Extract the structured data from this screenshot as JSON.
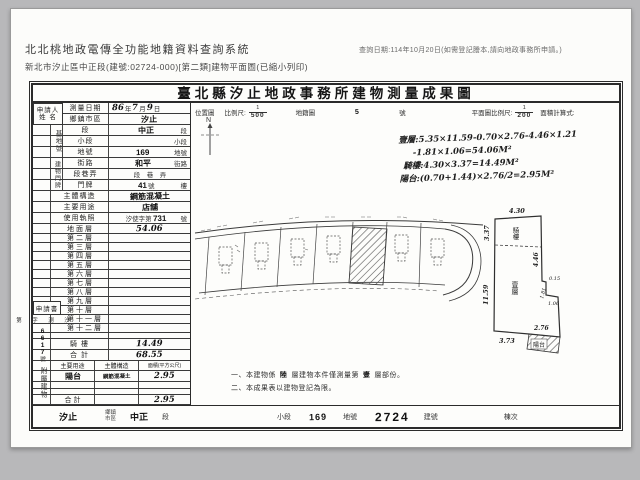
{
  "header": {
    "system_title": "北北桃地政電傳全功能地籍資料查詢系統",
    "query_date": "查詢日期:114年10月20日(如需登記謄本,請向地政事務所申請。)",
    "subtitle": "新北市汐止區中正段(建號:02724-000)[第二類]建物平面圖(已縮小列印)"
  },
  "doc": {
    "title": "臺北縣汐止地政事務所建物測量成果圖",
    "scalebar": {
      "loc": "位置圖",
      "scale": "比例尺:",
      "num1": "1",
      "den1": "500",
      "cad": "地籍圖",
      "sheet": "5",
      "unit": "號",
      "plan_scale": "平面圖比例尺:",
      "num2": "1",
      "den2": "200",
      "calc": "面積計算式:",
      "north": "N"
    },
    "calc_lines": [
      "壹層:5.35×11.59-0.70×2.76-4.46×1.21",
      "-1.81×1.06=54.06M²",
      "騎樓:4.30×3.37=14.49M²",
      "陽台:(0.70+1.44)×2.76/2=2.95M²"
    ],
    "left": {
      "applicant_line1": "申請人",
      "applicant_line2": "姓 名",
      "survey": {
        "label": "測量日期",
        "d1": "86",
        "u1": "年",
        "d2": "7",
        "u2": "月",
        "d3": "9",
        "u3": "日"
      },
      "site_tag": "基地號",
      "door_tag": "建物門牌",
      "rows": [
        {
          "label": "鄉鎮市區",
          "pre": "",
          "hand": "汐止",
          "mid": "",
          "post": ""
        },
        {
          "label": "段",
          "pre": "",
          "hand": "中正",
          "mid": "",
          "post": "段"
        },
        {
          "label": "小段",
          "pre": "",
          "hand": "",
          "mid": "",
          "post": "小段"
        },
        {
          "label": "地號",
          "pre": "",
          "hand": "169",
          "mid": "",
          "post": "地號"
        },
        {
          "label": "街路",
          "pre": "",
          "hand": "和平",
          "mid": "",
          "post": "街路"
        },
        {
          "label": "段巷弄",
          "pre": "",
          "hand": "",
          "mid": "段　巷　弄",
          "post": ""
        },
        {
          "label": "門牌",
          "pre": "",
          "hand": "41",
          "mid": "號",
          "post": "樓"
        },
        {
          "label": "主體構造",
          "pre": "",
          "hand": "鋼筋混凝土",
          "mid": "",
          "post": ""
        },
        {
          "label": "主要用途",
          "pre": "",
          "hand": "店舖",
          "mid": "",
          "post": ""
        },
        {
          "label": "使用執照",
          "pre": "汐使字第",
          "hand": "731",
          "mid": "",
          "post": "號"
        }
      ],
      "floors": [
        {
          "label": "地面層",
          "value": "54.06"
        },
        {
          "label": "第二層",
          "value": ""
        },
        {
          "label": "第三層",
          "value": ""
        },
        {
          "label": "第四層",
          "value": ""
        },
        {
          "label": "第五層",
          "value": ""
        },
        {
          "label": "第六層",
          "value": ""
        },
        {
          "label": "第七層",
          "value": ""
        },
        {
          "label": "第八層",
          "value": ""
        },
        {
          "label": "第九層",
          "value": ""
        },
        {
          "label": "第十層",
          "value": ""
        },
        {
          "label": "第十一層",
          "value": ""
        },
        {
          "label": "第十二層",
          "value": ""
        },
        {
          "label": "",
          "value": ""
        },
        {
          "label": "騎 樓",
          "value": "14.49"
        },
        {
          "label": "合 計",
          "value": "68.55"
        }
      ],
      "application_label": "申請書",
      "app_pre": "汐測字第",
      "app_no": "6617",
      "app_post": "號",
      "attached_tag": "附屬建物",
      "attached_headers": {
        "use": "主要用途",
        "structure": "主體構造",
        "area": "面積(平方公尺)"
      },
      "attached_rows": [
        {
          "use": "陽台",
          "structure": "鋼筋混凝土",
          "area": "2.95"
        },
        {
          "use": "",
          "structure": "",
          "area": ""
        },
        {
          "use": "",
          "structure": "",
          "area": ""
        },
        {
          "use": "合 計",
          "structure": "",
          "area": "2.95"
        }
      ]
    },
    "plan": {
      "top": "4.30",
      "left_top": "3.37",
      "arcade": "騎樓",
      "left": "11.59",
      "floor": "壹層",
      "right": "4.46",
      "notch1": "0.15",
      "notch2": "1.81",
      "notch3": "1.06",
      "bottom": "3.73",
      "balcony_w": "2.76",
      "balcony": "陽台"
    },
    "notes": {
      "n1a": "一、本建物係",
      "n1b": "陸",
      "n1c": "層建物本件僅測量第",
      "n1d": "壹",
      "n1e": "層部份。",
      "n2": "二、本成果表以建物登記為限。"
    },
    "bottom": {
      "v1": "汐止",
      "l1a": "鄉鎮",
      "l1b": "市區",
      "v2": "中正",
      "l2": "段",
      "l3": "小段",
      "v3": "169",
      "l4": "地號",
      "v4": "2724",
      "l5": "建號",
      "l6": "棟次"
    }
  }
}
